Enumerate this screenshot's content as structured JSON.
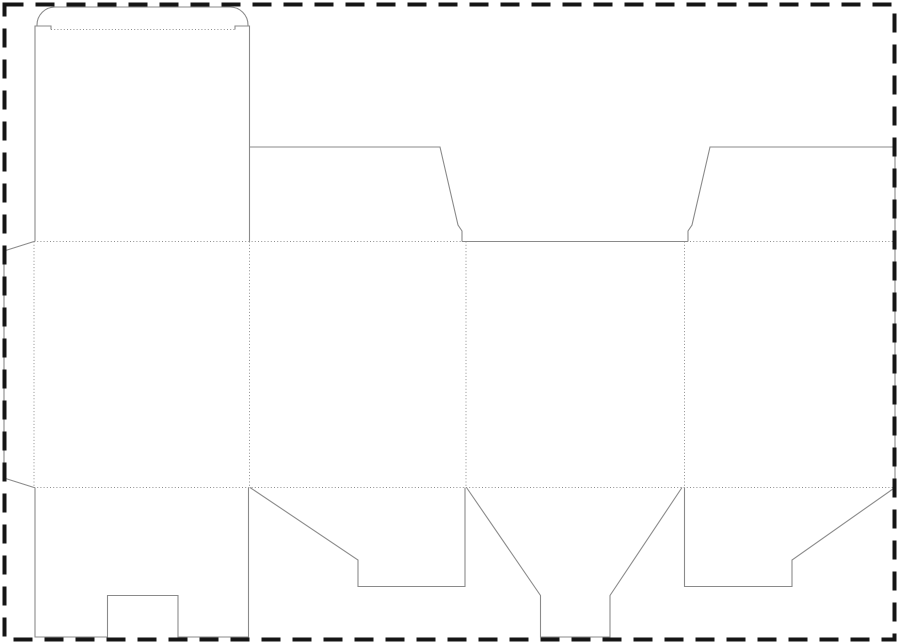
{
  "canvas": {
    "width": 900,
    "height": 644,
    "background": "#ffffff"
  },
  "styles": {
    "cut_color": "#8a8a8a",
    "cut_width": 1.1,
    "fold_color": "#8f8f8f",
    "fold_width": 1,
    "fold_dash": "1 2.2",
    "border_color": "#151515",
    "border_width": 4,
    "border_dash": "19 12"
  },
  "border": {
    "x": 4.5,
    "y": 4.5,
    "width": 890,
    "height": 635
  },
  "dieline": {
    "fold_lines": [
      {
        "name": "tuck-flap-fold-line",
        "d": "M51,29.5 L235,29.5"
      },
      {
        "name": "top-body-fold-line",
        "d": "M34,241.5 L895,241.5"
      },
      {
        "name": "bottom-body-fold-line",
        "d": "M34,487.5 L895,487.5"
      },
      {
        "name": "glue-flap-fold-line",
        "d": "M34,241.5 L34,487.5"
      },
      {
        "name": "panel-fold-line-1",
        "d": "M249.5,241.5 L249.5,487.5"
      },
      {
        "name": "panel-fold-line-2",
        "d": "M466,241.5 L466,487.5"
      },
      {
        "name": "panel-fold-line-3",
        "d": "M684.5,241.5 L684.5,487.5"
      }
    ],
    "cut_lines": [
      {
        "name": "glue-flap-outline",
        "d": "M34,241.5 L4,251 L4,478 L34,487.5"
      },
      {
        "name": "lid-left-edge-cut",
        "d": "M35,241.5 L35,26 L51,26 L51,29.5"
      },
      {
        "name": "lid-right-edge-cut",
        "d": "M235,29.5 L235,26 L249.5,26 L249.5,241.5"
      },
      {
        "name": "tuck-flap-outline",
        "d": "M37,26 L37,25 A18,18 0 0 1 55,7 L230,7 A18,18 0 0 1 248,25 L248,26"
      },
      {
        "name": "top-dust-flap-left-outline",
        "d": "M249.5,147 L440,147 L458,225 L462,231 L462,241.5"
      },
      {
        "name": "front-panel-top-edge-cut",
        "d": "M462,241.5 L688,241.5"
      },
      {
        "name": "top-dust-flap-right-outline",
        "d": "M688,241.5 L688,231 L692,225 L710,147 L895,147 L895,487.5"
      },
      {
        "name": "bottom-main-flap-notched-outline",
        "d": "M35,487.5 L35,637 L107.5,637 L107.5,595.5 L178,595.5 L178,637 L248.5,637 L248.5,487.5"
      },
      {
        "name": "bottom-side-flap-left-outline",
        "d": "M250,487.5 L358,560 L358,586.5 L465,586.5 L465,487.5"
      },
      {
        "name": "bottom-tongue-flap-outline",
        "d": "M466.5,487.5 L540.5,595.5 L540.5,637 L610,637 L610,595.5 L682,487.5"
      },
      {
        "name": "bottom-side-flap-right-outline",
        "d": "M684.5,487.5 L684.5,586.5 L792,586.5 L792,560 L895,487.5"
      }
    ]
  }
}
